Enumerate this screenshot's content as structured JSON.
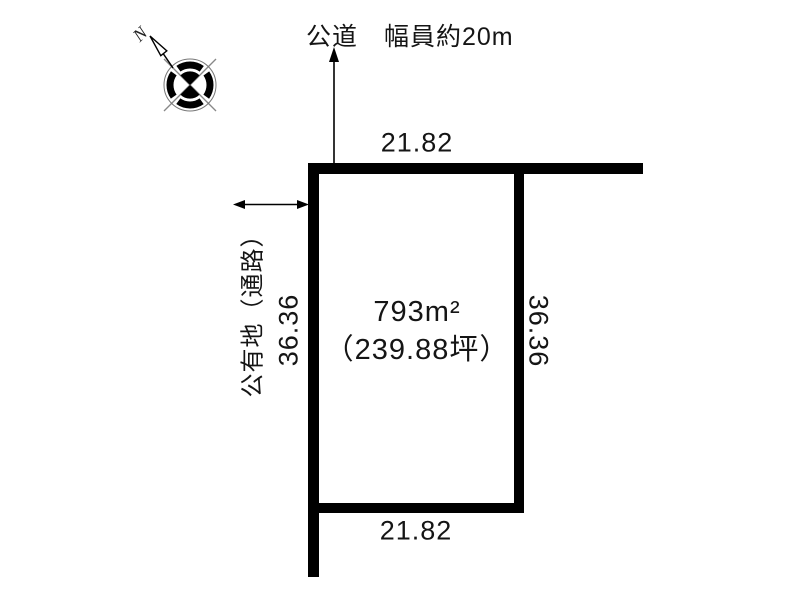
{
  "road": {
    "label": "公道　幅員約20m"
  },
  "plot": {
    "area_sqm": "793m²",
    "area_tsubo": "（239.88坪）",
    "dim_top": "21.82",
    "dim_bottom": "21.82",
    "dim_left": "36.36",
    "dim_right": "36.36"
  },
  "passage": {
    "label": "公有地（通路）"
  },
  "compass": {
    "north_label": "N"
  },
  "colors": {
    "boundary_line": "#000000",
    "thin_line": "#888888",
    "text": "#151515",
    "background": "#ffffff"
  }
}
